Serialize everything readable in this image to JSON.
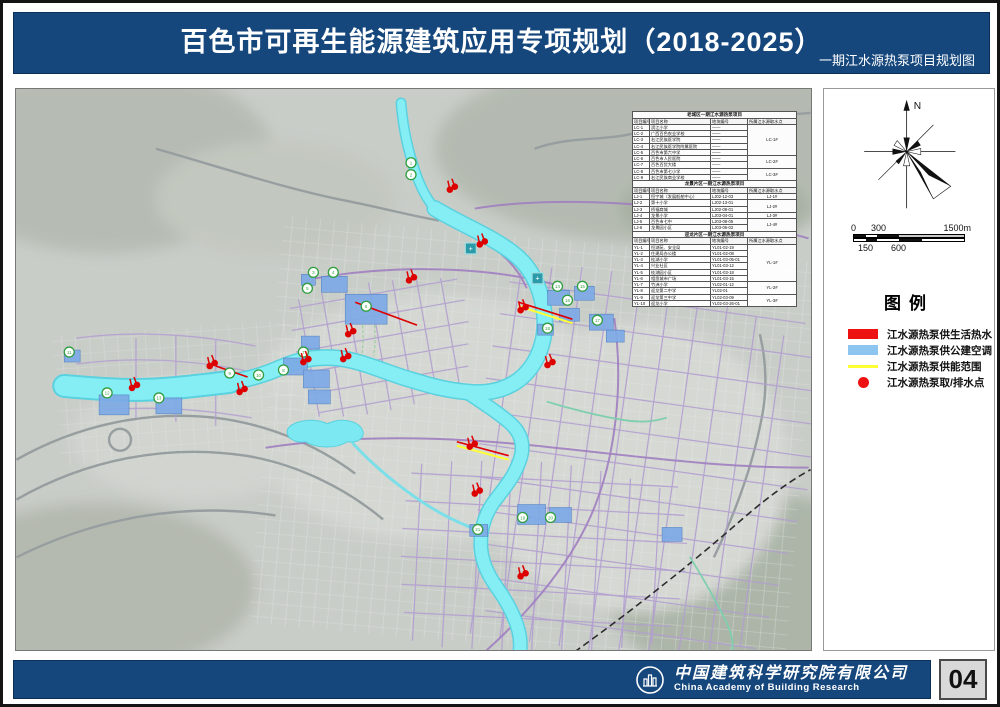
{
  "header": {
    "title": "百色市可再生能源建筑应用专项规划（2018-2025）",
    "subtitle": "一期江水源热泵项目规划图"
  },
  "map": {
    "table": {
      "columns": [
        "项目编号",
        "项目名称",
        "地块编号",
        "所属江水源取水点"
      ],
      "sections": [
        {
          "title": "老城区一期江水源热泵项目",
          "rows": [
            [
              "LC-1",
              "滨江小学",
              "——",
              {
                "label": "LC-1#",
                "span": 5
              }
            ],
            [
              "LC-2",
              "广西百色农业学校",
              "——",
              null
            ],
            [
              "LC-3",
              "右江民族医学院",
              "——",
              null
            ],
            [
              "LC-4",
              "右江民族医学院附属医院",
              "——",
              null
            ],
            [
              "LC-5",
              "百色市第六中学",
              "——",
              null
            ],
            [
              "LC-6",
              "百色市人民医院",
              "——",
              {
                "label": "LC-2#",
                "span": 2
              }
            ],
            [
              "LC-7",
              "百色百货大楼",
              "——",
              null
            ],
            [
              "LC-8",
              "百色市第七小学",
              "——",
              {
                "label": "LC-3#",
                "span": 2
              }
            ],
            [
              "LC-9",
              "右江民族商业学校",
              "——",
              null
            ]
          ]
        },
        {
          "title": "龙景片区一期江水源热泵项目",
          "rows": [
            [
              "LJ-1",
              "恒宁城（发展船舶中心）",
              "LJ02-12-03",
              {
                "label": "LJ-1#",
                "span": 1
              }
            ],
            [
              "LJ-2",
              "第十小学",
              "LJ02-13-01",
              {
                "label": "LJ-2#",
                "span": 2
              }
            ],
            [
              "LJ-3",
              "桥福商城",
              "LJ02-08-01",
              null
            ],
            [
              "LJ-4",
              "龙景小学",
              "LJ03-04-01",
              {
                "label": "LJ-3#",
                "span": 1
              }
            ],
            [
              "LJ-5",
              "百色市七中",
              "LJ03-08-05",
              {
                "label": "LJ-4#",
                "span": 2
              }
            ],
            [
              "LJ-6",
              "龙景园小区",
              "LJ03-06-02",
              null
            ]
          ]
        },
        {
          "title": "迎龙片区一期江水源热泵项目",
          "rows": [
            [
              "YL-1",
              "恒湖苑、安全局",
              "YL01-02-19",
              {
                "label": "YL-1#",
                "span": 6
              }
            ],
            [
              "YL-2",
              "住建局办公楼",
              "YL01-02-08",
              null
            ],
            [
              "YL-3",
              "桂湖小学",
              "YL01-03-05-01",
              null
            ],
            [
              "YL-4",
              "兴业社区",
              "YL01-03-12",
              null
            ],
            [
              "YL-5",
              "桂湖园小区",
              "YL01-03-18",
              null
            ],
            [
              "YL-6",
              "相思城市广场",
              "YL01-03-15",
              null
            ],
            [
              "YL-7",
              "竹洲小学",
              "YL02-01-12",
              {
                "label": "YL-2#",
                "span": 2
              }
            ],
            [
              "YL-8",
              "迎龙第二中学",
              "YL02-01",
              null
            ],
            [
              "YL-9",
              "迎龙第三中学",
              "YL02-03-09",
              {
                "label": "YL-3#",
                "span": 2
              }
            ],
            [
              "YL-10",
              "迎龙小学",
              "YL02-03-26-01",
              null
            ]
          ]
        }
      ]
    },
    "markers": [
      [
        435,
        99
      ],
      [
        465,
        154
      ],
      [
        394,
        190
      ],
      [
        506,
        220
      ],
      [
        533,
        275
      ],
      [
        328,
        269
      ],
      [
        288,
        272
      ],
      [
        194,
        276
      ],
      [
        116,
        298
      ],
      [
        224,
        302
      ],
      [
        455,
        357
      ],
      [
        460,
        404
      ],
      [
        506,
        487
      ],
      [
        333,
        244
      ]
    ],
    "badges": [
      {
        "x": 396,
        "y": 74,
        "label": "1"
      },
      {
        "x": 396,
        "y": 86,
        "label": "2"
      },
      {
        "x": 298,
        "y": 184,
        "label": "3"
      },
      {
        "x": 318,
        "y": 184,
        "label": "4"
      },
      {
        "x": 292,
        "y": 200,
        "label": "5"
      },
      {
        "x": 351,
        "y": 218,
        "label": "6"
      },
      {
        "x": 288,
        "y": 264,
        "label": "7"
      },
      {
        "x": 268,
        "y": 282,
        "label": "8"
      },
      {
        "x": 214,
        "y": 285,
        "label": "9"
      },
      {
        "x": 243,
        "y": 287,
        "label": "10"
      },
      {
        "x": 53,
        "y": 264,
        "label": "11"
      },
      {
        "x": 91,
        "y": 305,
        "label": "12"
      },
      {
        "x": 143,
        "y": 310,
        "label": "13"
      },
      {
        "x": 543,
        "y": 198,
        "label": "14"
      },
      {
        "x": 568,
        "y": 198,
        "label": "15"
      },
      {
        "x": 553,
        "y": 212,
        "label": "16"
      },
      {
        "x": 583,
        "y": 232,
        "label": "17"
      },
      {
        "x": 533,
        "y": 240,
        "label": "18"
      },
      {
        "x": 508,
        "y": 430,
        "label": "19"
      },
      {
        "x": 536,
        "y": 430,
        "label": "20"
      },
      {
        "x": 463,
        "y": 442,
        "label": "21"
      }
    ],
    "teal_icons": [
      [
        456,
        160
      ],
      [
        523,
        190
      ]
    ],
    "supply_lines_red": [
      [
        504,
        214,
        558,
        231
      ],
      [
        340,
        214,
        402,
        237
      ],
      [
        442,
        354,
        494,
        368
      ],
      [
        200,
        278,
        232,
        289
      ]
    ],
    "supply_lines_yellow": [
      [
        504,
        218,
        558,
        235
      ],
      [
        442,
        358,
        494,
        372
      ]
    ]
  },
  "sidebar": {
    "compass_label": "N",
    "scale": {
      "top_labels": [
        "0",
        "300",
        "1500m"
      ],
      "bottom_labels": [
        "150",
        "600"
      ]
    },
    "legend": {
      "title": "图例",
      "items": [
        {
          "label": "江水源热泵供生活热水",
          "swatch": "rect",
          "color": "#ee1111"
        },
        {
          "label": "江水源热泵供公建空调",
          "swatch": "rect",
          "color": "#8cc6f0"
        },
        {
          "label": "江水源热泵供能范围",
          "swatch": "line",
          "color": "#ffff33"
        },
        {
          "label": "江水源热泵取/排水点",
          "swatch": "dot",
          "color": "#ee1111"
        }
      ]
    }
  },
  "footer": {
    "company_cn": "中国建筑科学研究院有限公司",
    "company_en": "China Academy of Building Research",
    "page_number": "04"
  },
  "colors": {
    "banner_blue": "#16477c",
    "river_cyan": "#85eef5",
    "road_purple": "#b29fd0",
    "marker_red": "#dd0000",
    "building_blue": "#7daae6",
    "range_yellow": "#ffff33",
    "badge_green": "#2f9e3f"
  }
}
